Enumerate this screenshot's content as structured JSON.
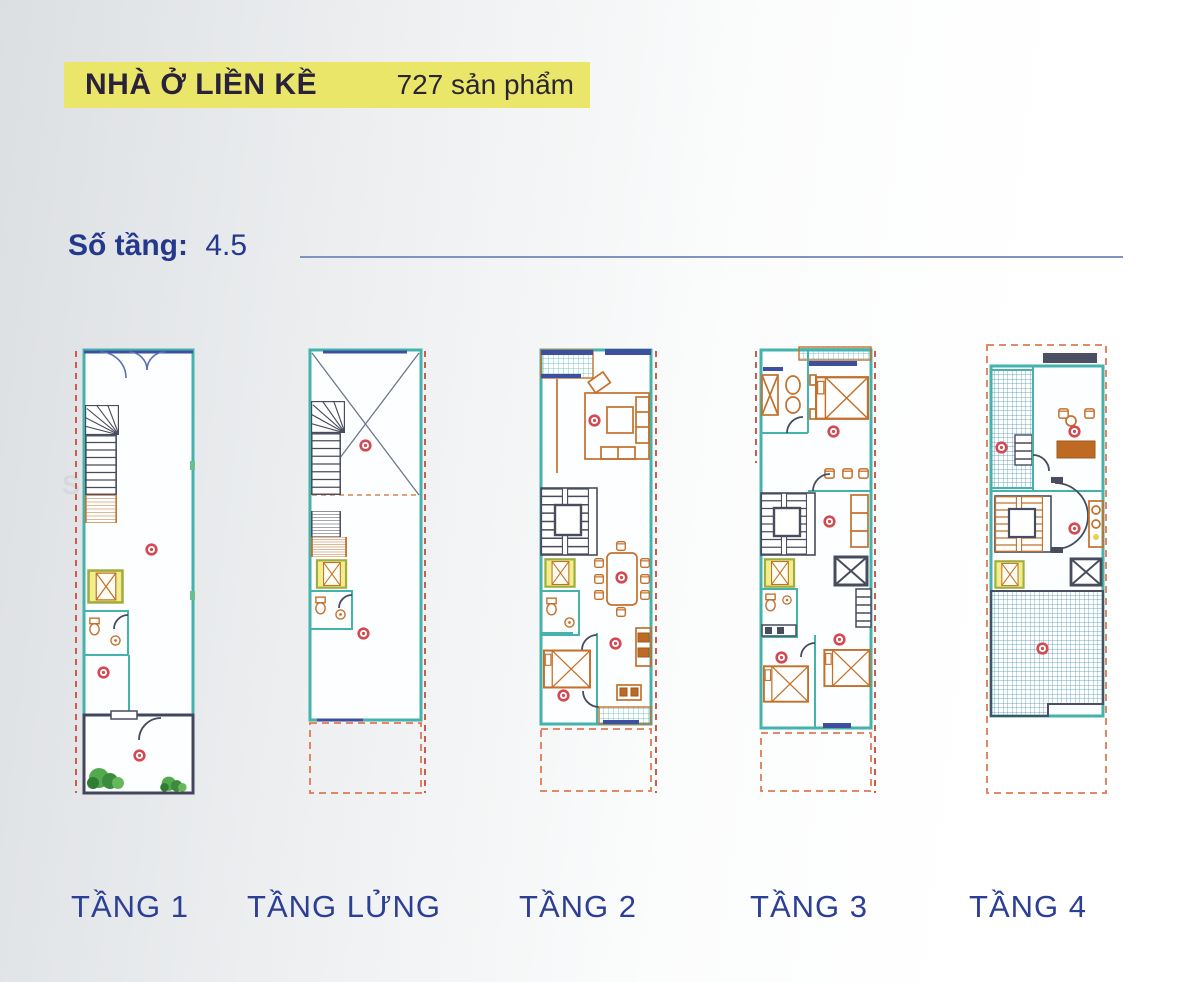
{
  "header": {
    "title": "NHÀ Ở LIỀN KỀ",
    "count": "727 sản phẩm"
  },
  "info": {
    "floors_label": "Số tầng:",
    "floors_value": "4.5"
  },
  "watermark": "ST AVIO",
  "plans": [
    {
      "id": "tang-1",
      "label": "TẦNG 1"
    },
    {
      "id": "tang-lung",
      "label": "TẦNG LỬNG"
    },
    {
      "id": "tang-2",
      "label": "TẦNG 2"
    },
    {
      "id": "tang-3",
      "label": "TẦNG 3"
    },
    {
      "id": "tang-4",
      "label": "TẦNG 4"
    }
  ],
  "colors": {
    "highlight_yellow": "#eae669",
    "heading_blue": "#24388c",
    "label_blue": "#2c3f96",
    "wall_teal": "#45b3ab",
    "furniture_orange": "#c4702a",
    "marker_red": "#d44a52",
    "lift_yellow": "#f2ee8c",
    "divider_blue": "#8094c1"
  }
}
